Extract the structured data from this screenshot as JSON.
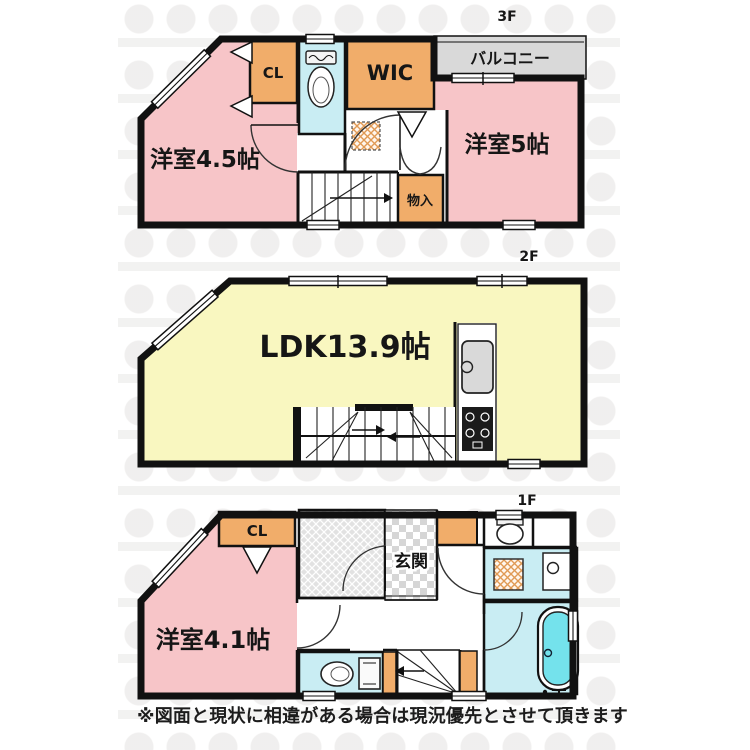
{
  "floor3": {
    "label": "3F",
    "room_left": "洋室4.5帖",
    "room_right": "洋室5帖",
    "closet": "CL",
    "wic": "WIC",
    "balcony": "バルコニー",
    "storage": "物入"
  },
  "floor2": {
    "label": "2F",
    "ldk": "LDK13.9帖"
  },
  "floor1": {
    "label": "1F",
    "room": "洋室4.1帖",
    "closet": "CL",
    "entrance": "玄関"
  },
  "footer": {
    "disclaimer": "※図面と現状に相違がある場合は現況優先とさせて頂きます"
  },
  "colors": {
    "room_pink": "#f7c5c8",
    "closet_orange": "#f1ad6a",
    "water_blue": "#c9edf3",
    "ldk_yellow": "#f9f7c0",
    "balcony_gray": "#d9d9d9",
    "bathtub_aqua": "#74e2ec",
    "wall_black": "#111111"
  }
}
